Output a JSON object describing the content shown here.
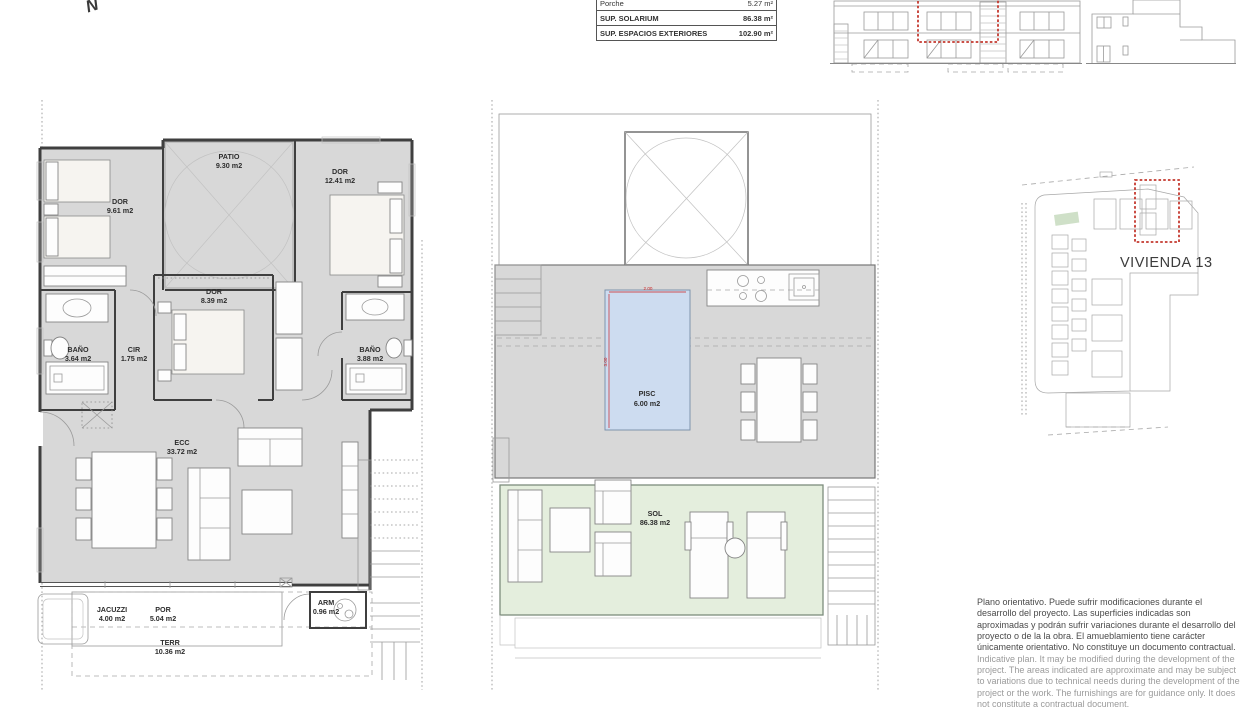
{
  "north_indicator": {
    "label": "N"
  },
  "surface_table": {
    "rows": [
      {
        "label": "Porche",
        "value": "5.27 m²"
      },
      {
        "label": "SUP. SOLARIUM",
        "value": "86.38 m²"
      },
      {
        "label": "SUP. ESPACIOS EXTERIORES",
        "value": "102.90 m²"
      }
    ]
  },
  "floor_plan": {
    "rooms": [
      {
        "name": "DOR",
        "area": "9.61 m2"
      },
      {
        "name": "PATIO",
        "area": "9.30 m2"
      },
      {
        "name": "DOR",
        "area": "12.41 m2"
      },
      {
        "name": "DOR",
        "area": "8.39 m2"
      },
      {
        "name": "BAÑO",
        "area": "3.64 m2"
      },
      {
        "name": "CIR",
        "area": "1.75 m2"
      },
      {
        "name": "BAÑO",
        "area": "3.88 m2"
      },
      {
        "name": "ECC",
        "area": "33.72 m2"
      },
      {
        "name": "JACUZZI",
        "area": "4.00 m2"
      },
      {
        "name": "POR",
        "area": "5.04 m2"
      },
      {
        "name": "TERR",
        "area": "10.36 m2"
      },
      {
        "name": "ARM",
        "area": "0.96 m2"
      }
    ]
  },
  "solarium_plan": {
    "rooms": [
      {
        "name": "PISC",
        "area": "6.00 m2"
      },
      {
        "name": "SOL",
        "area": "86.38 m2"
      }
    ],
    "pool_dimensions": {
      "width": "2.00",
      "length": "3.00"
    }
  },
  "site_plan": {
    "unit_label": "VIVIENDA 13"
  },
  "disclaimer": {
    "es": "Plano orientativo. Puede sufrir modificaciones durante el desarrollo del proyecto. Las superficies indicadas son aproximadas y podrán sufrir variaciones durante el desarrollo del proyecto o de la la obra. El amueblamiento tiene carácter únicamente orientativo. No constituye un documento contractual.",
    "en": "Indicative plan. It may be modified during the development of the project. The areas indicated are approximate and may be subject to variations due to technical needs during the development of the project or the work. The furnishings are for guidance only. It does not constitute a contractual document."
  },
  "colors": {
    "interior_floor": "#d8d8d8",
    "terrace": "#ececec",
    "pool": "#cddcf0",
    "solarium_deck": "#e4eedd",
    "highlight_red": "#c4392f",
    "dimension_red": "#cc2222",
    "wall": "#3f3f3f"
  }
}
